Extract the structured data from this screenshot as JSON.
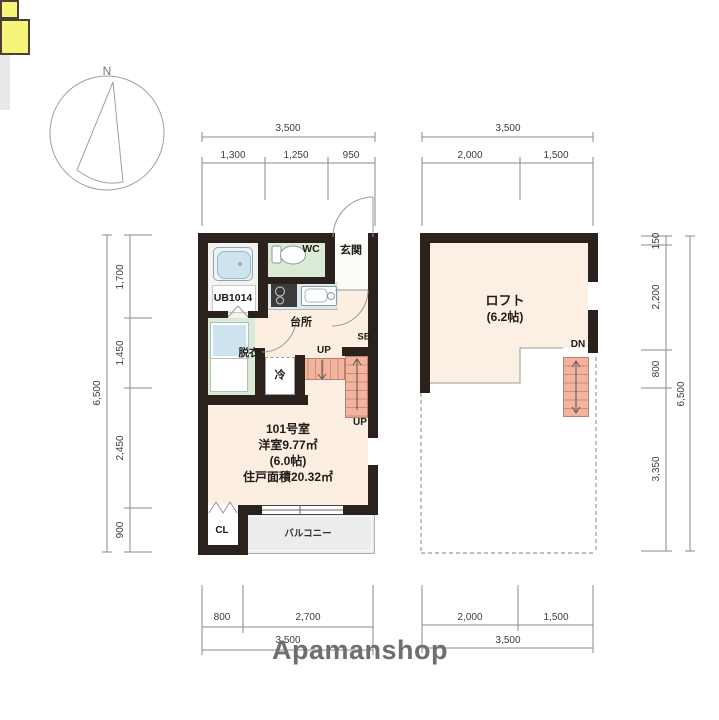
{
  "compass": {
    "north": "N"
  },
  "logo": {
    "brand": "Apamanshop"
  },
  "floor1": {
    "dims": {
      "top_total": "3,500",
      "top_segments": [
        "1,300",
        "1,250",
        "950"
      ],
      "left_total": "6,500",
      "left_segments": [
        "1,700",
        "1,450",
        "2,450",
        "900"
      ],
      "bottom_segments": [
        "800",
        "2,700"
      ],
      "bottom_total": "3,500"
    },
    "labels": {
      "unit_bath": "UB1014",
      "wc": "WC",
      "entrance": "玄関",
      "kitchen": "台所",
      "dressing": "脱衣",
      "fridge": "冷",
      "storage_sb": "SB",
      "up_top": "UP",
      "up_bottom": "UP",
      "closet": "CL",
      "balcony": "バルコニー"
    },
    "room_info": {
      "line1": "101号室",
      "line2": "洋室9.77㎡",
      "line3": "(6.0帖)",
      "line4": "住戸面積20.32㎡"
    }
  },
  "floor2": {
    "dims": {
      "top_total": "3,500",
      "top_segments": [
        "2,000",
        "1,500"
      ],
      "right_total": "6,500",
      "right_segments": [
        "150",
        "2,200",
        "800",
        "3,350"
      ],
      "bottom_segments": [
        "2,000",
        "1,500"
      ],
      "bottom_total": "3,500"
    },
    "labels": {
      "loft": "ロフト",
      "loft_size": "(6.2帖)",
      "down": "DN"
    }
  },
  "colors": {
    "wall": "#2b211d",
    "room_floor": "#fceee1",
    "wet_area_floor": "#d9ebd4",
    "fixture_blue": "#cde4ef",
    "stairs_salmon": "#f2b49e",
    "accent_yellow": "#f8f379",
    "balcony_gray": "#ececec",
    "dimension_line": "#8a8a8a",
    "logo_gray": "#6f6f6f"
  }
}
